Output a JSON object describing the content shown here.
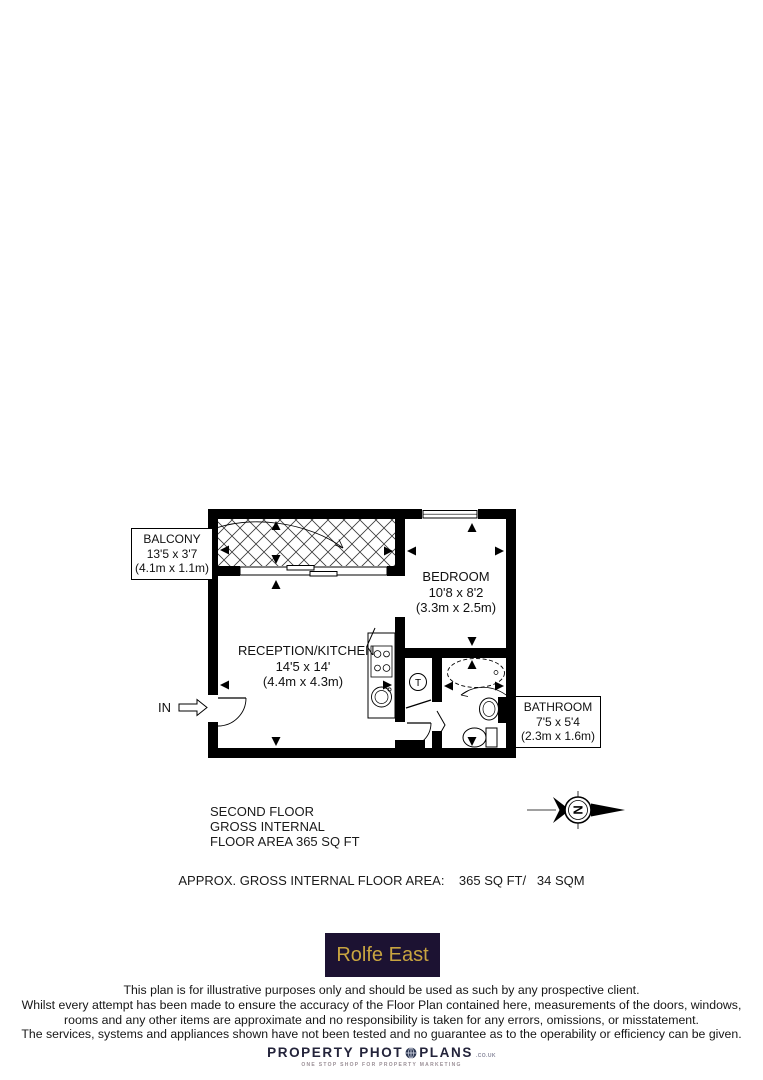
{
  "plan": {
    "rooms": [
      {
        "name": "BALCONY",
        "size_imperial": "13'5 x 3'7",
        "size_metric": "(4.1m x 1.1m)"
      },
      {
        "name": "BEDROOM",
        "size_imperial": "10'8 x 8'2",
        "size_metric": "(3.3m x 2.5m)"
      },
      {
        "name": "RECEPTION/KITCHEN",
        "size_imperial": "14'5 x 14'",
        "size_metric": "(4.4m x 4.3m)"
      },
      {
        "name": "BATHROOM",
        "size_imperial": "7'5 x 5'4",
        "size_metric": "(2.3m x 1.6m)"
      }
    ],
    "entrance_label": "IN",
    "tank_label": "T",
    "compass_north_label": "N"
  },
  "summary": {
    "line1": "SECOND FLOOR",
    "line2": "GROSS INTERNAL",
    "line3": "FLOOR AREA 365 SQ FT"
  },
  "area_statement": "APPROX. GROSS INTERNAL FLOOR AREA:    365 SQ FT/   34 SQM",
  "agency_logo": {
    "text": "Rolfe East",
    "background": "#1c1232",
    "color": "#c8a440"
  },
  "disclaimer": {
    "line1": "This plan is for illustrative purposes only and should be used as such by any prospective client.",
    "line2": "Whilst every attempt has been made to ensure the accuracy of the Floor Plan contained here, measurements of the doors, windows,",
    "line3": "rooms and any other items are approximate and no responsibility is taken for any errors, omissions, or misstatement.",
    "line4": "The services, systems and appliances shown have not been tested and no guarantee as to the operability or efficiency can be given."
  },
  "footer_logo": {
    "name_part1": "PROPERTY PHOT",
    "name_part2": "PLANS",
    "domain_suffix": ".CO.UK",
    "tagline": "ONE STOP SHOP FOR PROPERTY MARKETING"
  }
}
